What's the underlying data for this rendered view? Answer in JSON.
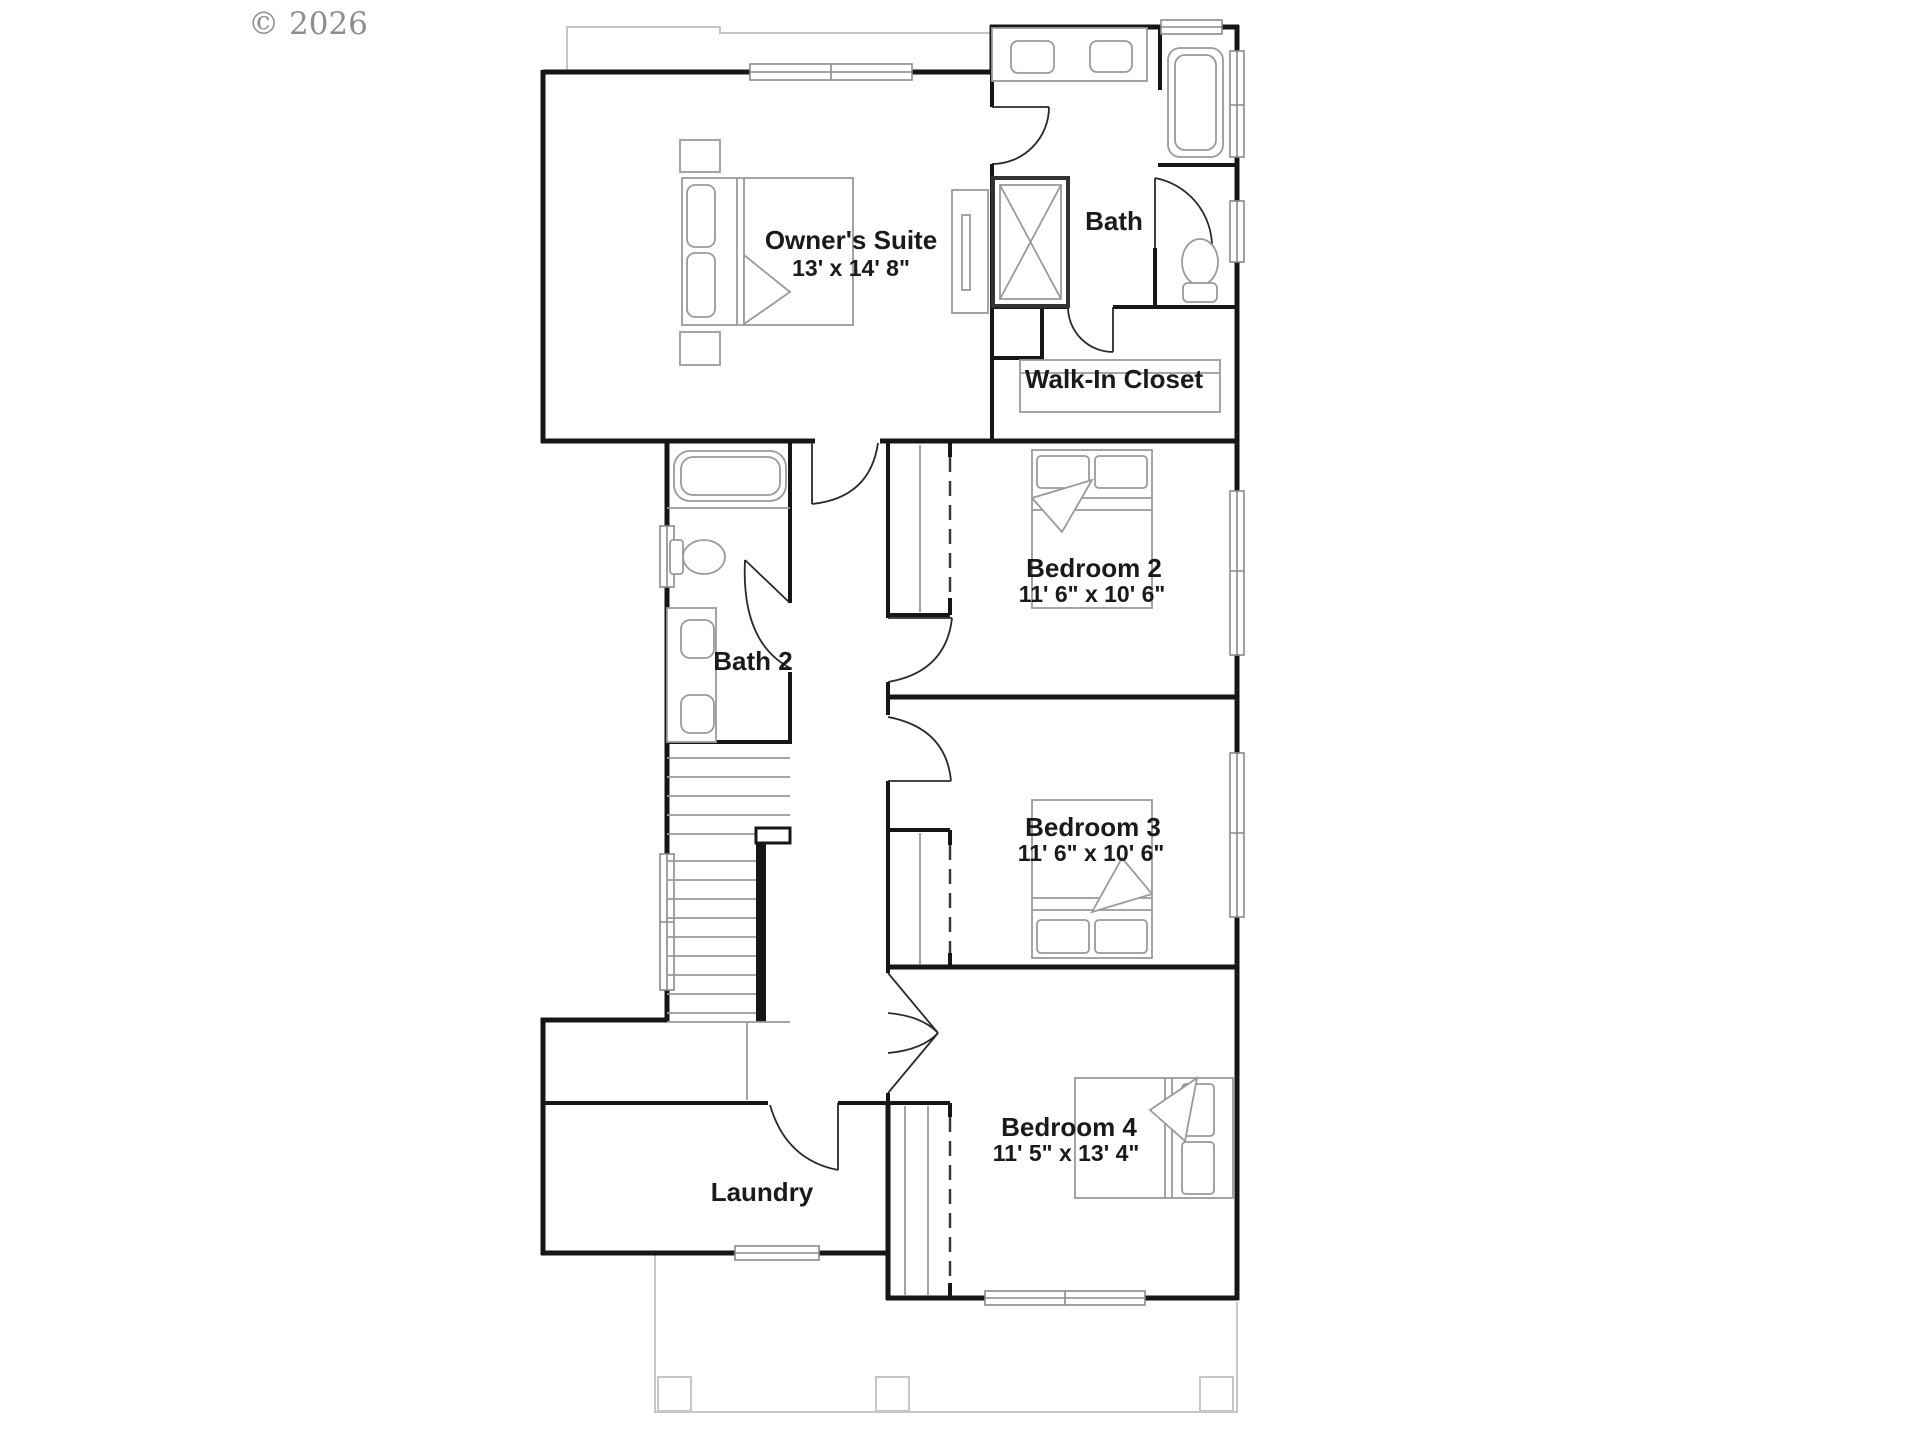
{
  "watermark": {
    "text": "© 2026"
  },
  "rooms": {
    "owners_suite": {
      "name": "Owner's Suite",
      "dims": "13' x 14' 8\""
    },
    "bath": {
      "name": "Bath"
    },
    "walk_in_closet": {
      "name": "Walk-In Closet"
    },
    "bedroom2": {
      "name": "Bedroom 2",
      "dims": "11' 6\" x 10' 6\""
    },
    "bath2": {
      "name": "Bath 2"
    },
    "bedroom3": {
      "name": "Bedroom 3",
      "dims": "11' 6\" x 10' 6\""
    },
    "bedroom4": {
      "name": "Bedroom 4",
      "dims": "11' 5\" x 13' 4\""
    },
    "laundry": {
      "name": "Laundry"
    }
  },
  "colors": {
    "wall": "#161616",
    "fixture": "#9a9a9a",
    "guide": "#c6c6c6",
    "label": "#1a1a1a",
    "watermark": "#8e8e8e"
  }
}
